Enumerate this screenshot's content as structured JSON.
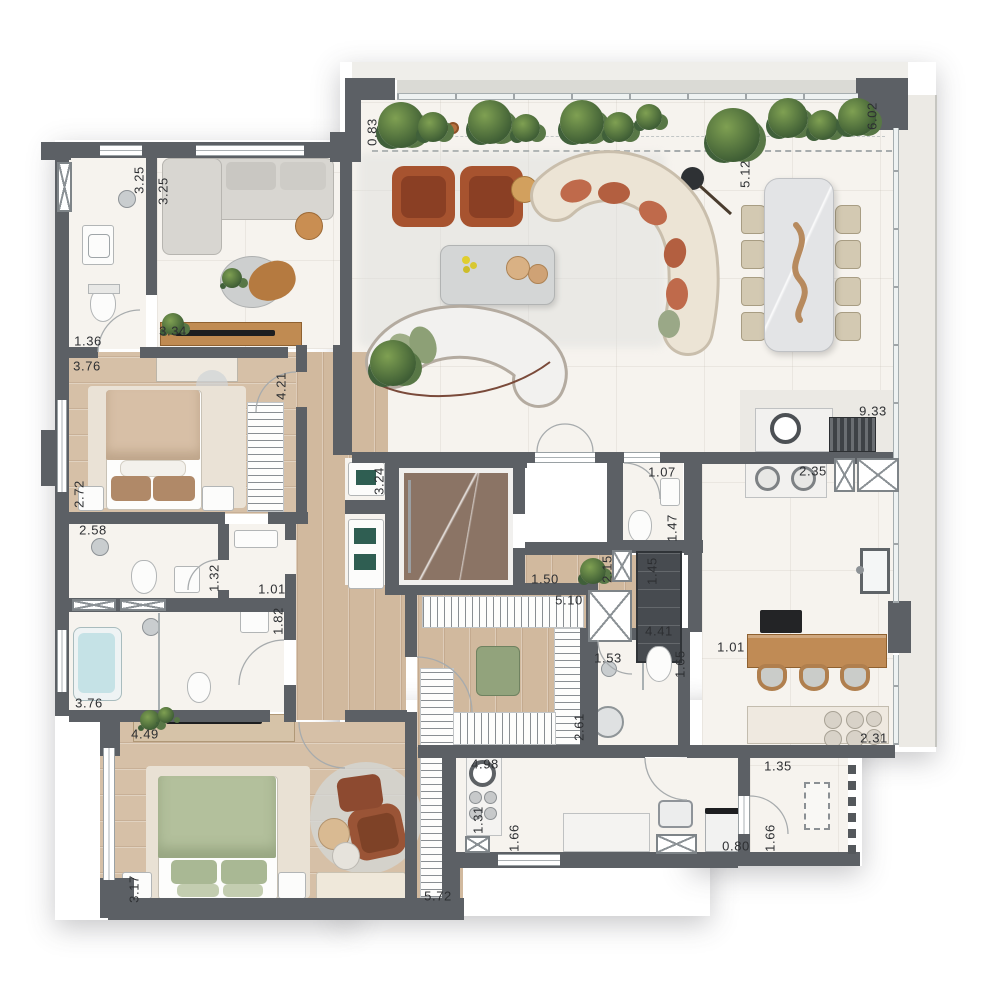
{
  "plan": {
    "type": "apartment-floor-plan",
    "units": "meters"
  },
  "palette": {
    "wall": "#5c6065",
    "marble_floor": "#f6f3ee",
    "wood_floor": "#d1b99e",
    "stone_floor": "#ebe9e4",
    "elevator_floor": "#8b7465",
    "accent_green": "#97a67f",
    "accent_terracotta": "#a7532f",
    "plant_green": "#3f5e35",
    "bathtub_blue": "#c5e2e6",
    "cabinet_teal": "#2f5e52",
    "island_wood": "#c08b55"
  },
  "dimension_labels": [
    {
      "text": "0.83",
      "x": 372,
      "y": 132,
      "vertical": true
    },
    {
      "text": "3.25",
      "x": 139,
      "y": 180,
      "vertical": true
    },
    {
      "text": "3.25",
      "x": 163,
      "y": 191,
      "vertical": true
    },
    {
      "text": "1.36",
      "x": 88,
      "y": 341,
      "vertical": false
    },
    {
      "text": "3.34",
      "x": 173,
      "y": 331,
      "vertical": false
    },
    {
      "text": "3.76",
      "x": 87,
      "y": 366,
      "vertical": false
    },
    {
      "text": "4.21",
      "x": 281,
      "y": 386,
      "vertical": true
    },
    {
      "text": "2.72",
      "x": 79,
      "y": 494,
      "vertical": true
    },
    {
      "text": "2.58",
      "x": 93,
      "y": 530,
      "vertical": false
    },
    {
      "text": "1.32",
      "x": 214,
      "y": 578,
      "vertical": true
    },
    {
      "text": "1.01",
      "x": 272,
      "y": 589,
      "vertical": false
    },
    {
      "text": "1.82",
      "x": 278,
      "y": 621,
      "vertical": true
    },
    {
      "text": "3.76",
      "x": 89,
      "y": 703,
      "vertical": false
    },
    {
      "text": "4.49",
      "x": 145,
      "y": 734,
      "vertical": false
    },
    {
      "text": "3.17",
      "x": 134,
      "y": 889,
      "vertical": true
    },
    {
      "text": "5.72",
      "x": 438,
      "y": 896,
      "vertical": false
    },
    {
      "text": "6.02",
      "x": 872,
      "y": 116,
      "vertical": true
    },
    {
      "text": "5.12",
      "x": 745,
      "y": 174,
      "vertical": true
    },
    {
      "text": "3.24",
      "x": 379,
      "y": 481,
      "vertical": true
    },
    {
      "text": "1.07",
      "x": 662,
      "y": 472,
      "vertical": false
    },
    {
      "text": "1.47",
      "x": 672,
      "y": 528,
      "vertical": true
    },
    {
      "text": "1.50",
      "x": 545,
      "y": 579,
      "vertical": false
    },
    {
      "text": "2.15",
      "x": 607,
      "y": 569,
      "vertical": true
    },
    {
      "text": "1.45",
      "x": 652,
      "y": 571,
      "vertical": true
    },
    {
      "text": "4.41",
      "x": 659,
      "y": 631,
      "vertical": false
    },
    {
      "text": "5.10",
      "x": 569,
      "y": 600,
      "vertical": false
    },
    {
      "text": "2.61",
      "x": 579,
      "y": 727,
      "vertical": true
    },
    {
      "text": "1.53",
      "x": 608,
      "y": 658,
      "vertical": false
    },
    {
      "text": "1.65",
      "x": 680,
      "y": 664,
      "vertical": true
    },
    {
      "text": "4.98",
      "x": 485,
      "y": 764,
      "vertical": false
    },
    {
      "text": "1.31",
      "x": 478,
      "y": 820,
      "vertical": true
    },
    {
      "text": "1.66",
      "x": 514,
      "y": 838,
      "vertical": true
    },
    {
      "text": "0.80",
      "x": 736,
      "y": 846,
      "vertical": false
    },
    {
      "text": "1.66",
      "x": 770,
      "y": 838,
      "vertical": true
    },
    {
      "text": "1.35",
      "x": 778,
      "y": 766,
      "vertical": false
    },
    {
      "text": "9.33",
      "x": 873,
      "y": 411,
      "vertical": false
    },
    {
      "text": "2.35",
      "x": 813,
      "y": 471,
      "vertical": false
    },
    {
      "text": "1.01",
      "x": 731,
      "y": 647,
      "vertical": false
    },
    {
      "text": "2.31",
      "x": 874,
      "y": 738,
      "vertical": false
    }
  ]
}
